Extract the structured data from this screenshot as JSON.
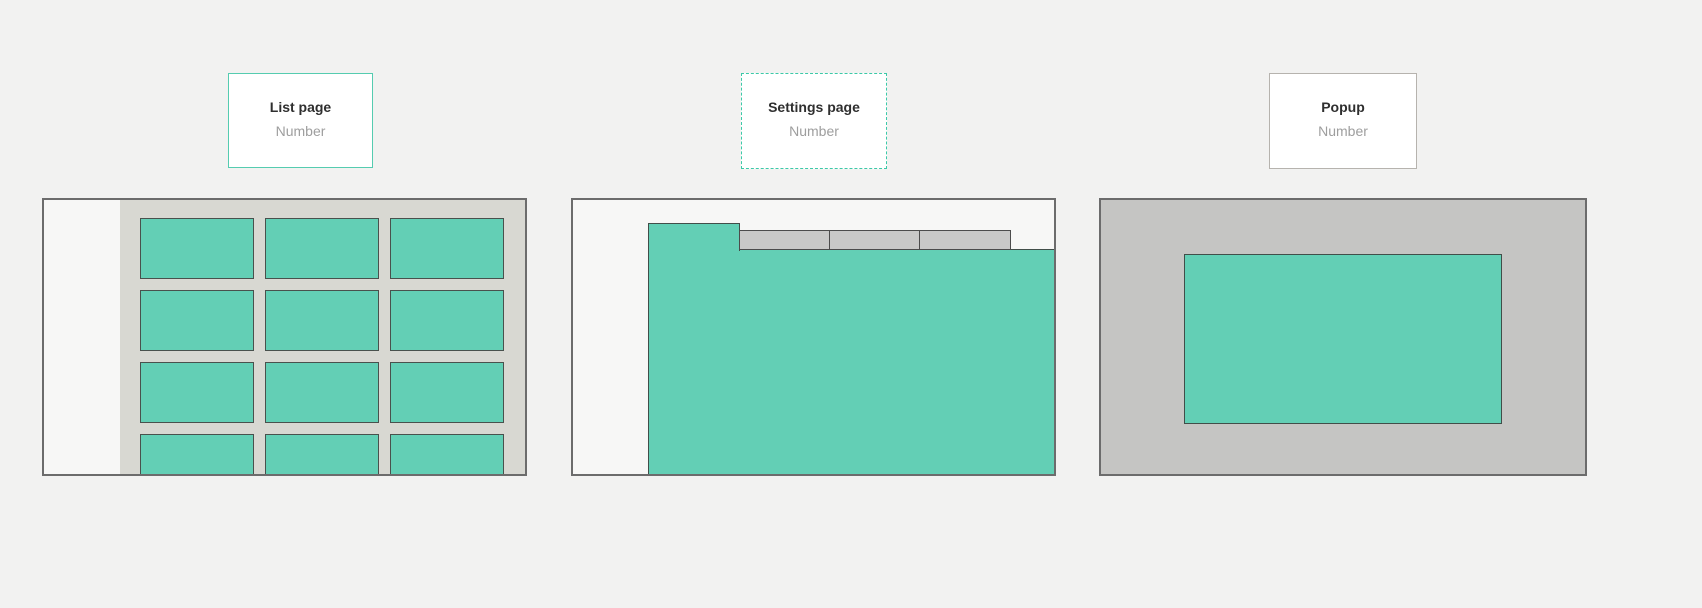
{
  "page": {
    "background_color": "#f2f2f1"
  },
  "colors": {
    "accent_teal": "#63cfb5",
    "teal_card_border": "#55ccb0",
    "dashed_card_border": "#3cc9a8",
    "gray_card_border": "#b6b3ae",
    "panel_border": "#6c6c6c",
    "shape_border": "#414e49",
    "list_background": "#d8d8d2",
    "tab_gray": "#c9c9c8",
    "popup_overlay_gray": "#c5c5c3",
    "sidebar_white": "#f7f7f6"
  },
  "screens": [
    {
      "label": "List page",
      "sublabel": "Number",
      "card_border": "solid teal",
      "wireframe": "grid-of-cards",
      "grid": {
        "columns": 3,
        "rows": 4
      },
      "has_left_sidebar": true
    },
    {
      "label": "Settings page",
      "sublabel": "Number",
      "card_border": "dashed teal",
      "wireframe": "tabbed-content",
      "tabs": {
        "active_count": 1,
        "inactive_count": 3
      },
      "has_left_sidebar": true
    },
    {
      "label": "Popup",
      "sublabel": "Number",
      "card_border": "solid gray",
      "wireframe": "modal-over-overlay"
    }
  ]
}
